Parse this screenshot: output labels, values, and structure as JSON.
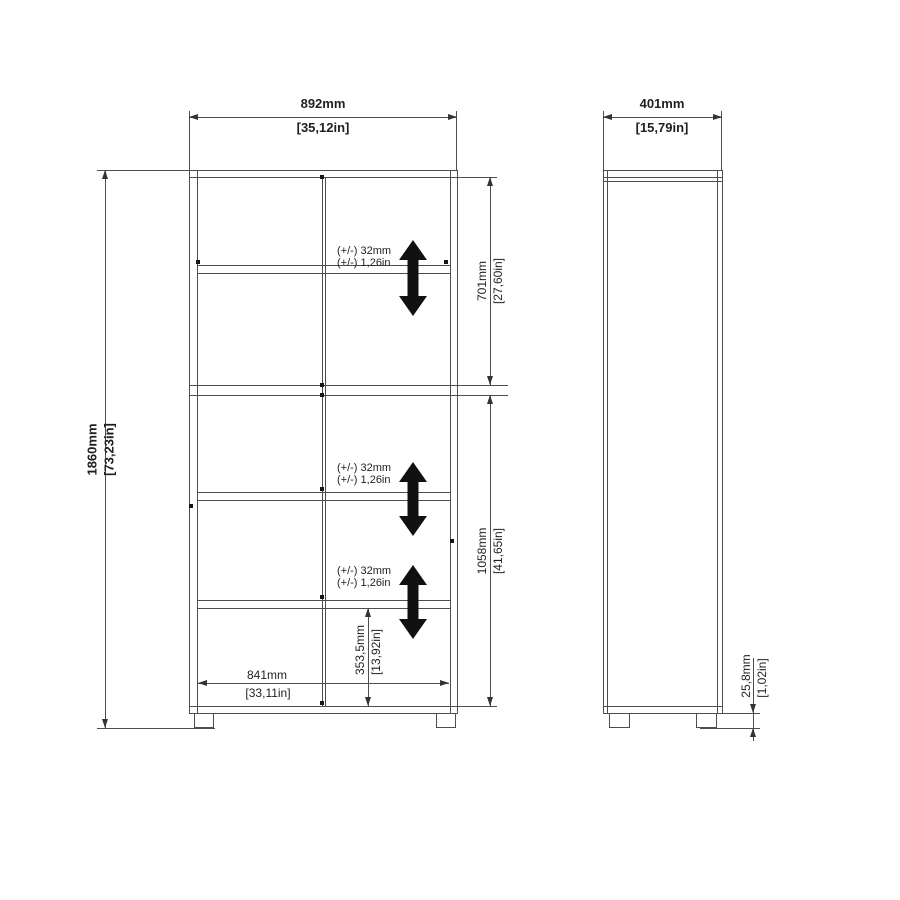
{
  "colors": {
    "background": "#ffffff",
    "line": "#4d4d4d",
    "text": "#1f1f1f",
    "adjust_arrow": "#111111"
  },
  "front_view": {
    "overall_width": {
      "mm": "892mm",
      "inches": "[35,12in]"
    },
    "overall_height": {
      "mm": "1860mm",
      "inches": "[73,23in]"
    },
    "top_section_height": {
      "mm": "701mm",
      "inches": "[27,60in]"
    },
    "bottom_section_height": {
      "mm": "1058mm",
      "inches": "[41,65in]"
    },
    "bottom_shelf_height": {
      "mm": "353,5mm",
      "inches": "[13,92in]"
    },
    "internal_width": {
      "mm": "841mm",
      "inches": "[33,11in]"
    },
    "shelf_adjustability": [
      {
        "mm": "(+/-) 32mm",
        "inches": "(+/-) 1,26in"
      },
      {
        "mm": "(+/-) 32mm",
        "inches": "(+/-) 1,26in"
      },
      {
        "mm": "(+/-) 32mm",
        "inches": "(+/-) 1,26in"
      }
    ]
  },
  "side_view": {
    "overall_depth": {
      "mm": "401mm",
      "inches": "[15,79in]"
    },
    "foot_height": {
      "mm": "25,8mm",
      "inches": "[1,02in]"
    }
  },
  "icons": {
    "shelf_adjust_arrow": "double-headed-vertical-arrow"
  }
}
